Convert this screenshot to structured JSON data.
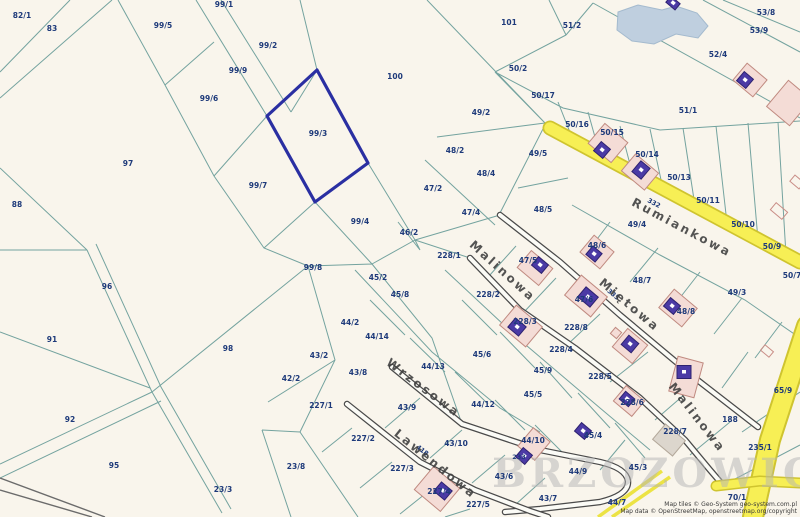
{
  "map": {
    "selected_parcel": "99/3",
    "watermark": "BRZOZOWICZ",
    "attribution": [
      "Map tiles © Geo-System geo-system.com.pl",
      "Map data © OpenStreetMap, openstreetmap.org/copyright"
    ],
    "colors": {
      "background": "#f9f5ec",
      "parcel_line": "#74a39f",
      "parcel_label": "#1e3a7a",
      "selected_outline": "#2a2fa2",
      "road_yellow": "#f7ef55",
      "building_pink": "#f4dcd6",
      "building_purple": "#4b3aa5",
      "pond": "#bfcfdf"
    },
    "streets": [
      {
        "t": "Rumiankowa",
        "x": 680,
        "y": 231,
        "rot": 28
      },
      {
        "t": "Malinowa",
        "x": 500,
        "y": 274,
        "rot": 42
      },
      {
        "t": "Malinowa",
        "x": 694,
        "y": 420,
        "rot": 52
      },
      {
        "t": "Miętowa",
        "x": 627,
        "y": 308,
        "rot": 40
      },
      {
        "t": "Wrzosowa",
        "x": 421,
        "y": 391,
        "rot": 37
      },
      {
        "t": "Lawendowa",
        "x": 433,
        "y": 467,
        "rot": 39
      }
    ],
    "road_refs": [
      {
        "t": "332",
        "x": 653,
        "y": 205,
        "rot": 28
      },
      {
        "t": "335",
        "x": 612,
        "y": 296,
        "rot": 40
      },
      {
        "t": "233",
        "x": 519,
        "y": 459,
        "rot": 0
      },
      {
        "t": "418",
        "x": 421,
        "y": 452,
        "rot": 39
      }
    ],
    "parcel_labels": [
      {
        "t": "82/1",
        "x": 22,
        "y": 18
      },
      {
        "t": "83",
        "x": 52,
        "y": 31
      },
      {
        "t": "99/5",
        "x": 163,
        "y": 28
      },
      {
        "t": "99/1",
        "x": 224,
        "y": 7
      },
      {
        "t": "99/2",
        "x": 268,
        "y": 48
      },
      {
        "t": "99/9",
        "x": 238,
        "y": 73
      },
      {
        "t": "99/6",
        "x": 209,
        "y": 101
      },
      {
        "t": "99/3",
        "x": 318,
        "y": 136
      },
      {
        "t": "97",
        "x": 128,
        "y": 166
      },
      {
        "t": "88",
        "x": 17,
        "y": 207
      },
      {
        "t": "99/7",
        "x": 258,
        "y": 188
      },
      {
        "t": "99/4",
        "x": 360,
        "y": 224
      },
      {
        "t": "99/8",
        "x": 313,
        "y": 270
      },
      {
        "t": "96",
        "x": 107,
        "y": 289
      },
      {
        "t": "91",
        "x": 52,
        "y": 342
      },
      {
        "t": "98",
        "x": 228,
        "y": 351
      },
      {
        "t": "92",
        "x": 70,
        "y": 422
      },
      {
        "t": "95",
        "x": 114,
        "y": 468
      },
      {
        "t": "23/3",
        "x": 223,
        "y": 492
      },
      {
        "t": "23/8",
        "x": 296,
        "y": 469
      },
      {
        "t": "42/2",
        "x": 291,
        "y": 381
      },
      {
        "t": "43/2",
        "x": 319,
        "y": 358
      },
      {
        "t": "43/8",
        "x": 358,
        "y": 375
      },
      {
        "t": "44/2",
        "x": 350,
        "y": 325
      },
      {
        "t": "44/14",
        "x": 377,
        "y": 339
      },
      {
        "t": "45/2",
        "x": 378,
        "y": 280
      },
      {
        "t": "45/8",
        "x": 400,
        "y": 297
      },
      {
        "t": "46/2",
        "x": 409,
        "y": 235
      },
      {
        "t": "100",
        "x": 395,
        "y": 79
      },
      {
        "t": "101",
        "x": 509,
        "y": 25
      },
      {
        "t": "51/2",
        "x": 572,
        "y": 28
      },
      {
        "t": "53/8",
        "x": 766,
        "y": 15
      },
      {
        "t": "53/9",
        "x": 759,
        "y": 33
      },
      {
        "t": "52/4",
        "x": 718,
        "y": 57
      },
      {
        "t": "50/2",
        "x": 518,
        "y": 71
      },
      {
        "t": "50/17",
        "x": 543,
        "y": 98
      },
      {
        "t": "49/2",
        "x": 481,
        "y": 115
      },
      {
        "t": "51/1",
        "x": 688,
        "y": 113
      },
      {
        "t": "50/16",
        "x": 577,
        "y": 127
      },
      {
        "t": "50/15",
        "x": 612,
        "y": 135
      },
      {
        "t": "50/14",
        "x": 647,
        "y": 157
      },
      {
        "t": "50/13",
        "x": 679,
        "y": 180
      },
      {
        "t": "50/11",
        "x": 708,
        "y": 203
      },
      {
        "t": "50/10",
        "x": 743,
        "y": 227
      },
      {
        "t": "50/9",
        "x": 772,
        "y": 249
      },
      {
        "t": "50/7",
        "x": 792,
        "y": 278
      },
      {
        "t": "49/5",
        "x": 538,
        "y": 156
      },
      {
        "t": "48/2",
        "x": 455,
        "y": 153
      },
      {
        "t": "48/4",
        "x": 486,
        "y": 176
      },
      {
        "t": "47/2",
        "x": 433,
        "y": 191
      },
      {
        "t": "47/4",
        "x": 471,
        "y": 215
      },
      {
        "t": "48/5",
        "x": 543,
        "y": 212
      },
      {
        "t": "49/4",
        "x": 637,
        "y": 227
      },
      {
        "t": "48/6",
        "x": 597,
        "y": 248
      },
      {
        "t": "47/5",
        "x": 528,
        "y": 263
      },
      {
        "t": "228/1",
        "x": 449,
        "y": 258
      },
      {
        "t": "48/7",
        "x": 642,
        "y": 283
      },
      {
        "t": "47/6",
        "x": 584,
        "y": 302
      },
      {
        "t": "49/3",
        "x": 737,
        "y": 295
      },
      {
        "t": "48/8",
        "x": 686,
        "y": 314
      },
      {
        "t": "228/2",
        "x": 488,
        "y": 297
      },
      {
        "t": "228/3",
        "x": 525,
        "y": 324
      },
      {
        "t": "228/8",
        "x": 576,
        "y": 330
      },
      {
        "t": "228/4",
        "x": 561,
        "y": 352
      },
      {
        "t": "228/5",
        "x": 600,
        "y": 379
      },
      {
        "t": "45/9",
        "x": 543,
        "y": 373
      },
      {
        "t": "45/5",
        "x": 533,
        "y": 397
      },
      {
        "t": "45/6",
        "x": 482,
        "y": 357
      },
      {
        "t": "44/13",
        "x": 433,
        "y": 369
      },
      {
        "t": "44/12",
        "x": 483,
        "y": 407
      },
      {
        "t": "43/9",
        "x": 407,
        "y": 410
      },
      {
        "t": "227/1",
        "x": 321,
        "y": 408
      },
      {
        "t": "227/2",
        "x": 363,
        "y": 441
      },
      {
        "t": "227/3",
        "x": 402,
        "y": 471
      },
      {
        "t": "227/4",
        "x": 439,
        "y": 494
      },
      {
        "t": "227/5",
        "x": 478,
        "y": 507
      },
      {
        "t": "43/10",
        "x": 456,
        "y": 446
      },
      {
        "t": "44/10",
        "x": 533,
        "y": 443
      },
      {
        "t": "43/6",
        "x": 504,
        "y": 479
      },
      {
        "t": "43/7",
        "x": 548,
        "y": 501
      },
      {
        "t": "44/9",
        "x": 578,
        "y": 474
      },
      {
        "t": "44/7",
        "x": 617,
        "y": 505
      },
      {
        "t": "45/4",
        "x": 593,
        "y": 438
      },
      {
        "t": "45/3",
        "x": 638,
        "y": 470
      },
      {
        "t": "228/6",
        "x": 632,
        "y": 405
      },
      {
        "t": "228/7",
        "x": 675,
        "y": 434
      },
      {
        "t": "65/9",
        "x": 783,
        "y": 393
      },
      {
        "t": "188",
        "x": 730,
        "y": 422
      },
      {
        "t": "235/1",
        "x": 760,
        "y": 450
      },
      {
        "t": "70/1",
        "x": 737,
        "y": 500
      }
    ]
  }
}
